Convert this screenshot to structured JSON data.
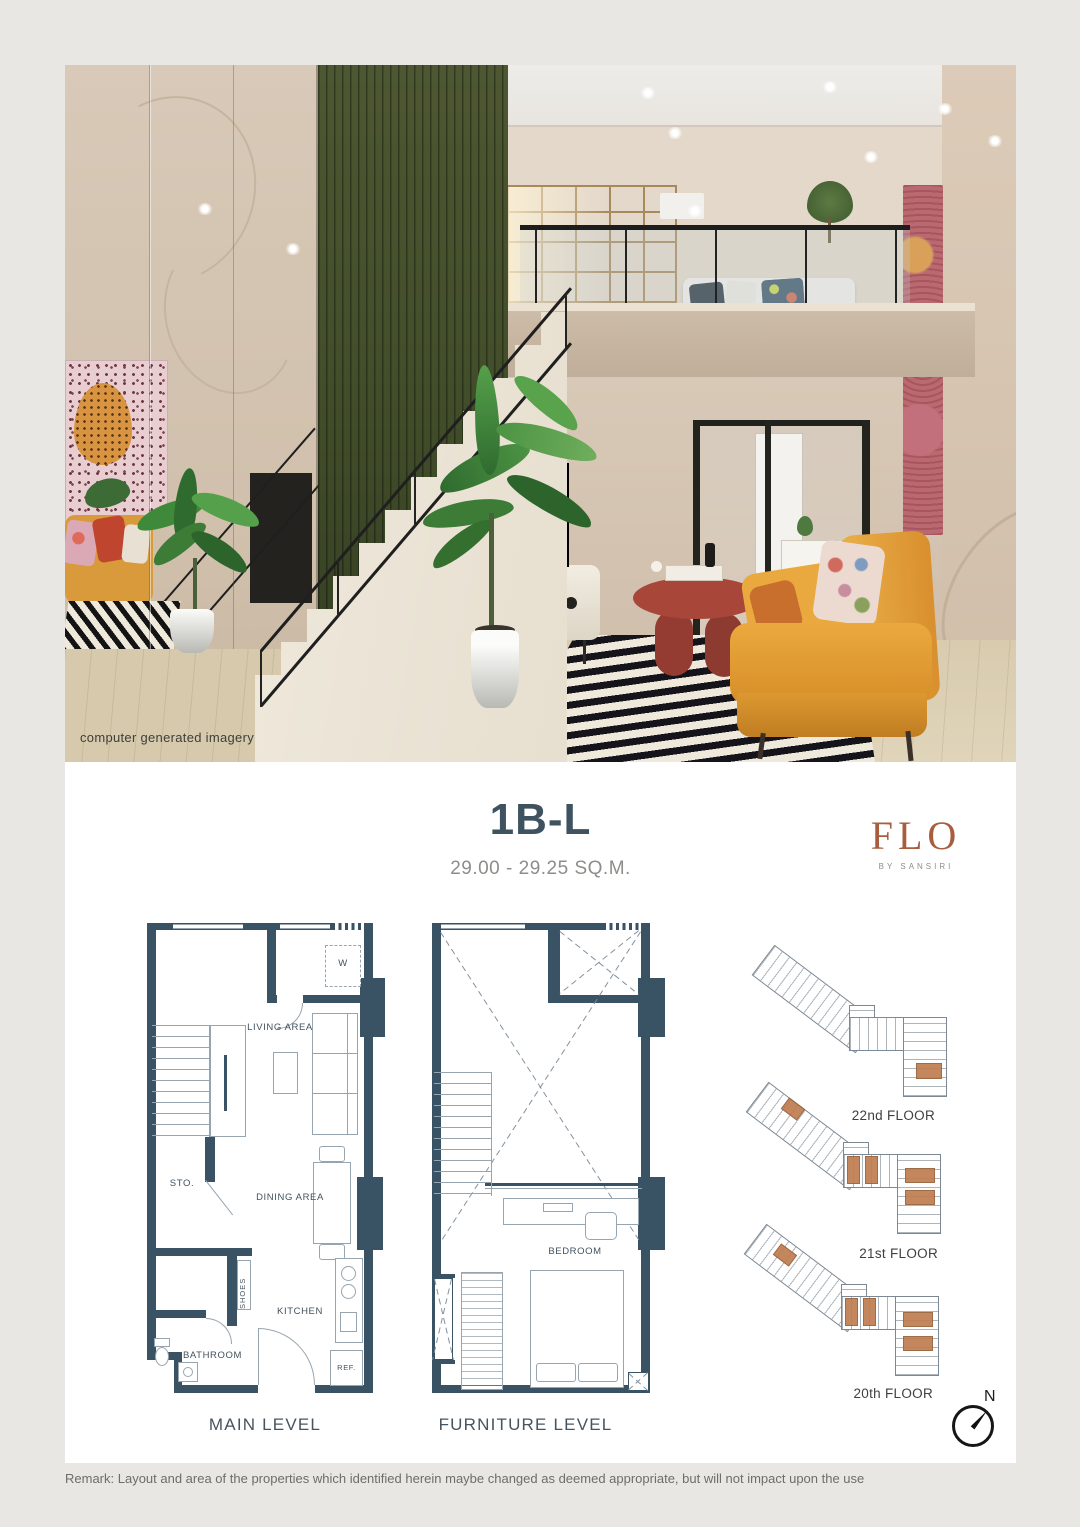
{
  "photo": {
    "caption": "computer generated imagery"
  },
  "header": {
    "unit_type": "1B-L",
    "area_range": "29.00 - 29.25 SQ.M.",
    "brand": {
      "name": "FLO",
      "byline": "BY SANSIRI"
    }
  },
  "plans": {
    "main": {
      "caption": "MAIN LEVEL",
      "labels": {
        "washer": "W",
        "living": "LIVING AREA",
        "storage": "STO.",
        "dining": "DINING AREA",
        "shoes": "SHOES",
        "kitchen": "KITCHEN",
        "bathroom": "BATHROOM",
        "fridge": "REF."
      }
    },
    "furniture": {
      "caption": "FURNITURE LEVEL",
      "labels": {
        "bedroom": "BEDROOM"
      }
    }
  },
  "floors": [
    {
      "label": "22nd FLOOR"
    },
    {
      "label": "21st FLOOR"
    },
    {
      "label": "20th FLOOR"
    }
  ],
  "compass": {
    "north_label": "N"
  },
  "footer": {
    "remark": "Remark: Layout and area of the properties which identified herein maybe changed as deemed appropriate, but will not impact upon the use"
  },
  "colors": {
    "page_bg": "#e8e7e3",
    "card_bg": "#ffffff",
    "title": "#3e5260",
    "subtitle": "#8e8d8a",
    "accent": "#a85d3e",
    "byline": "#8f8d86",
    "wall": "#3a5364",
    "line": "#97a5b0",
    "label": "#42525e",
    "caption": "#46545f",
    "floor_label": "#3f3f3f",
    "remark": "#6e6d67",
    "unit": "#bf7c4f",
    "green_wall": "#414c29",
    "sofa": "#e2a23a",
    "table": "#a8463a"
  }
}
